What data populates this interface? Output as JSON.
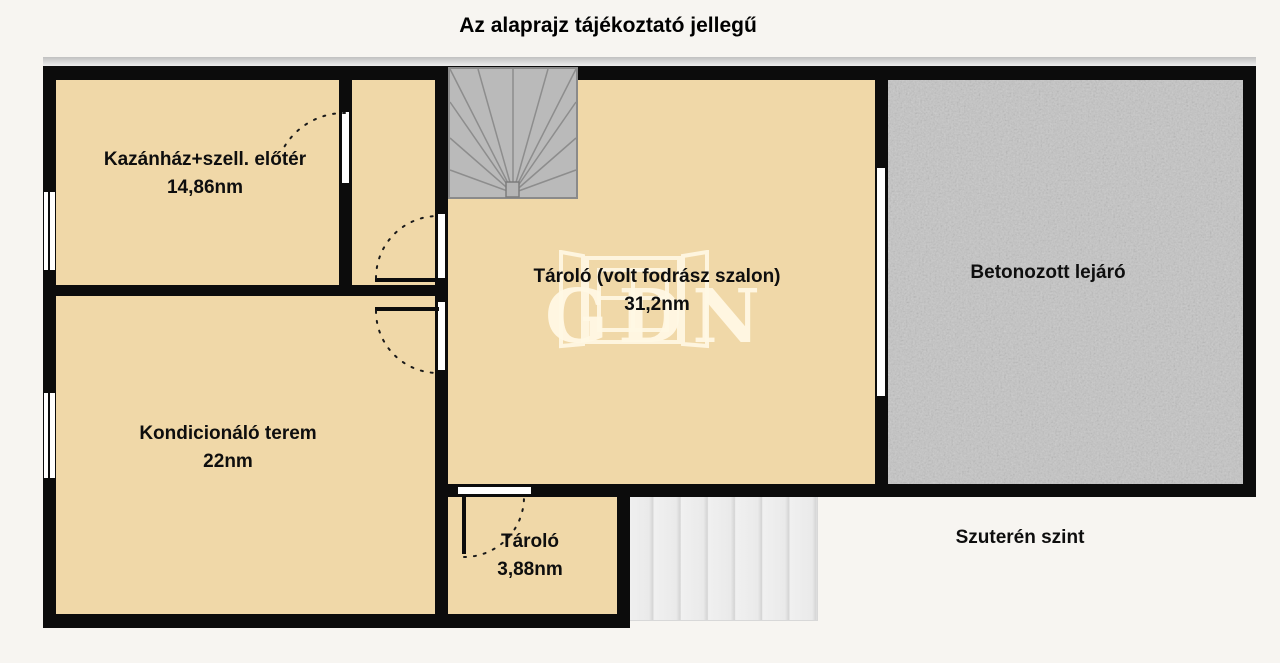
{
  "plan": {
    "title": "Az alaprajz tájékoztató jellegű",
    "level_label": "Szuterén szint",
    "watermark": "GDN",
    "rooms": {
      "boiler": {
        "name": "Kazánház+szell. előtér",
        "area": "14,86nm"
      },
      "storage_main": {
        "name": "Tároló (volt fodrász szalon)",
        "area": "31,2nm"
      },
      "concrete_ramp": {
        "name": "Betonozott lejáró"
      },
      "gym": {
        "name": "Kondicionáló terem",
        "area": "22nm"
      },
      "storage_small": {
        "name": "Tároló",
        "area": "3,88nm"
      }
    },
    "colors": {
      "background": "#f7f5f1",
      "room_fill": "#f0d8a8",
      "wall": "#0c0c0c",
      "concrete": "#c5c5c5",
      "winder_stairs": "#bababa",
      "entry_steps": "#ededed",
      "watermark": "#fdf4e0"
    }
  }
}
